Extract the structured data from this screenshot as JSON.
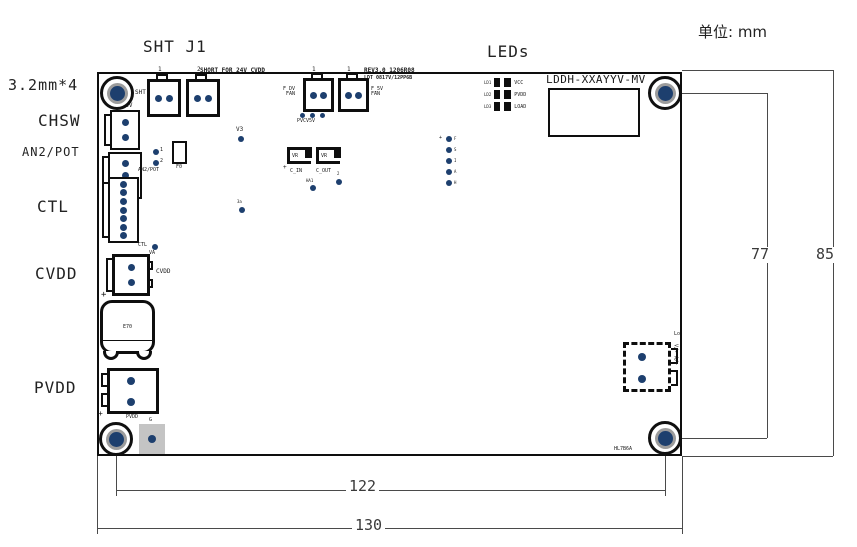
{
  "unit_label": "单位: mm",
  "callouts": {
    "hole_spec": "3.2mm*4",
    "sht_j1": "SHT J1",
    "leds": "LEDs",
    "chsw": "CHSW",
    "an2_pot": "AN2/POT",
    "ctl": "CTL",
    "cvdd": "CVDD",
    "pvdd": "PVDD"
  },
  "dimensions": {
    "hole_pitch_vertical": "77",
    "board_height": "85",
    "hole_pitch_horizontal": "122",
    "board_width": "130"
  },
  "silk": {
    "sht": "SHT",
    "chsv": "CHSV",
    "j1_pin1": "1",
    "j1_pin2": "2",
    "short_note": "SHORT FOR 24V CVDD",
    "rev1": "REV3.0  1206R08",
    "rev2": "LDT 0817V/12PP6B",
    "fan1_pin": "1",
    "fan2_pin": "1",
    "fan1": "F_DV\nFAN",
    "fan2": "F_5V\nFAN",
    "pvcv5v": "PVCV5V",
    "part_no": "LDDH-XXAYYV-MV",
    "v3": "V3",
    "vr1": "VR",
    "vr2": "VR",
    "cin_plus": "+",
    "c_in": "C_IN",
    "c_out": "C_OUT",
    "ha1": "HA1",
    "tp2": "2",
    "tp3a": "3a",
    "an2_pot": "AN2/POT",
    "f0": "F0",
    "tp_a1": "1",
    "tp_a2": "2",
    "ctl": "CTL",
    "va": "VA",
    "cvdd": "CVDD",
    "cap_plus": "+",
    "e70": "E70",
    "pvdd_plus": "+",
    "pvdd": "PVDD",
    "g": "G",
    "lo": "Lo",
    "out_pins": "V/-  A/+",
    "hole_note": "HL7B6A"
  },
  "leds": {
    "rows": [
      {
        "id": "LD1",
        "name": "VCC"
      },
      {
        "id": "LD2",
        "name": "PVDD"
      },
      {
        "id": "LD3",
        "name": "LOAD"
      }
    ]
  },
  "testpoints": {
    "plus": "+",
    "labels": [
      "F",
      "S",
      "I",
      "A",
      "H"
    ]
  }
}
